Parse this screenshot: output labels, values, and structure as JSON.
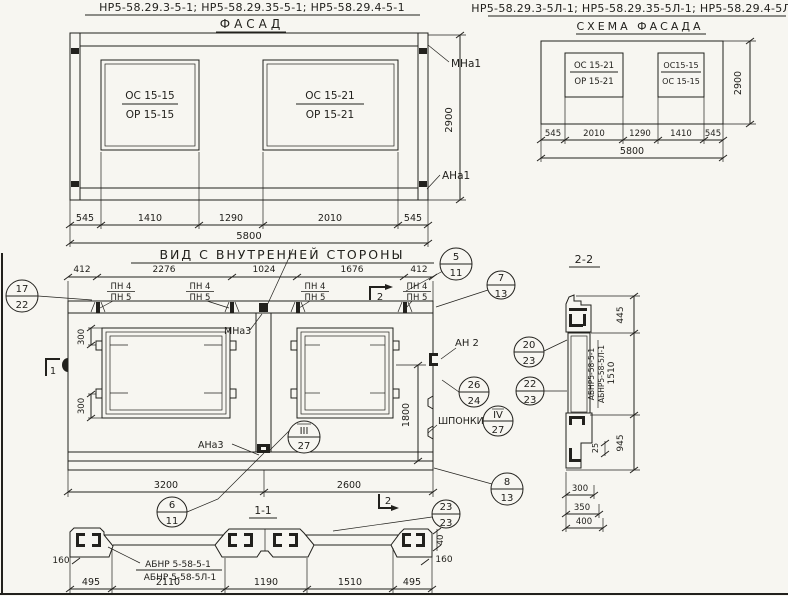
{
  "facade": {
    "codes": "НР5-58.29.3-5-1; НР5-58.29.35-5-1; НР5-58.29.4-5-1",
    "title": "ФАСАД",
    "win_left_top": "ОС 15-15",
    "win_left_bot": "ОР 15-15",
    "win_right_top": "ОС 15-21",
    "win_right_bot": "ОР 15-21",
    "anchor_top": "МНа1",
    "anchor_bottom": "АНа1",
    "dim_height": "2900",
    "dims": [
      "545",
      "1410",
      "1290",
      "2010",
      "545"
    ],
    "dim_total": "5800"
  },
  "scheme": {
    "codes": "НР5-58.29.3-5Л-1; НР5-58.29.35-5Л-1; НР5-58.29.4-5Л-1",
    "title": "СХЕМА ФАСАДА",
    "win_left_top": "ОС 15-21",
    "win_left_bot": "ОР 15-21",
    "win_right_top": "ОС15-15",
    "win_right_bot": "ОС 15-15",
    "dim_height": "2900",
    "dims": [
      "545",
      "2010",
      "1290",
      "1410",
      "545"
    ],
    "dim_total": "5800"
  },
  "inner": {
    "title": "ВИД С ВНУТРЕННЕЙ СТОРОНЫ",
    "dims_top": [
      "412",
      "2276",
      "1024",
      "1676",
      "412"
    ],
    "pn4": "ПН 4",
    "pn5": "ПН 5",
    "mna3": "МНа3",
    "ana3": "АНа3",
    "an2": "АН 2",
    "shponki": "ШПОНКИ",
    "dim300": "300",
    "dim1800": "1800",
    "dim3200": "3200",
    "dim2600": "2600",
    "marker1": "1",
    "marker2": "2"
  },
  "sec11": {
    "title": "1-1",
    "label_top": "АБНР 5-58-5-1",
    "label_bot": "АБНР 5-58-5Л-1",
    "dim160": "160",
    "dim40": "40",
    "dims": [
      "495",
      "2110",
      "1190",
      "1510",
      "495"
    ]
  },
  "sec22": {
    "title": "2-2",
    "label_top": "АБНР5-58-5-1",
    "label_bot": "АБНР5-58-5Л-1",
    "dim445": "445",
    "dim1510": "1510",
    "dim945": "945",
    "dim25": "25",
    "dims_bottom": [
      "300",
      "350",
      "400"
    ]
  },
  "bubbles": {
    "b17": {
      "t": "17",
      "b": "22"
    },
    "b5": {
      "t": "5",
      "b": "11"
    },
    "b7": {
      "t": "7",
      "b": "13"
    },
    "b20": {
      "t": "20",
      "b": "23"
    },
    "b26": {
      "t": "26",
      "b": "24"
    },
    "b22": {
      "t": "22",
      "b": "23"
    },
    "b4r": {
      "t": "IV",
      "b": "27"
    },
    "b3r": {
      "t": "III",
      "b": "27"
    },
    "b8": {
      "t": "8",
      "b": "13"
    },
    "b6": {
      "t": "6",
      "b": "11"
    },
    "b23": {
      "t": "23",
      "b": "23"
    }
  }
}
